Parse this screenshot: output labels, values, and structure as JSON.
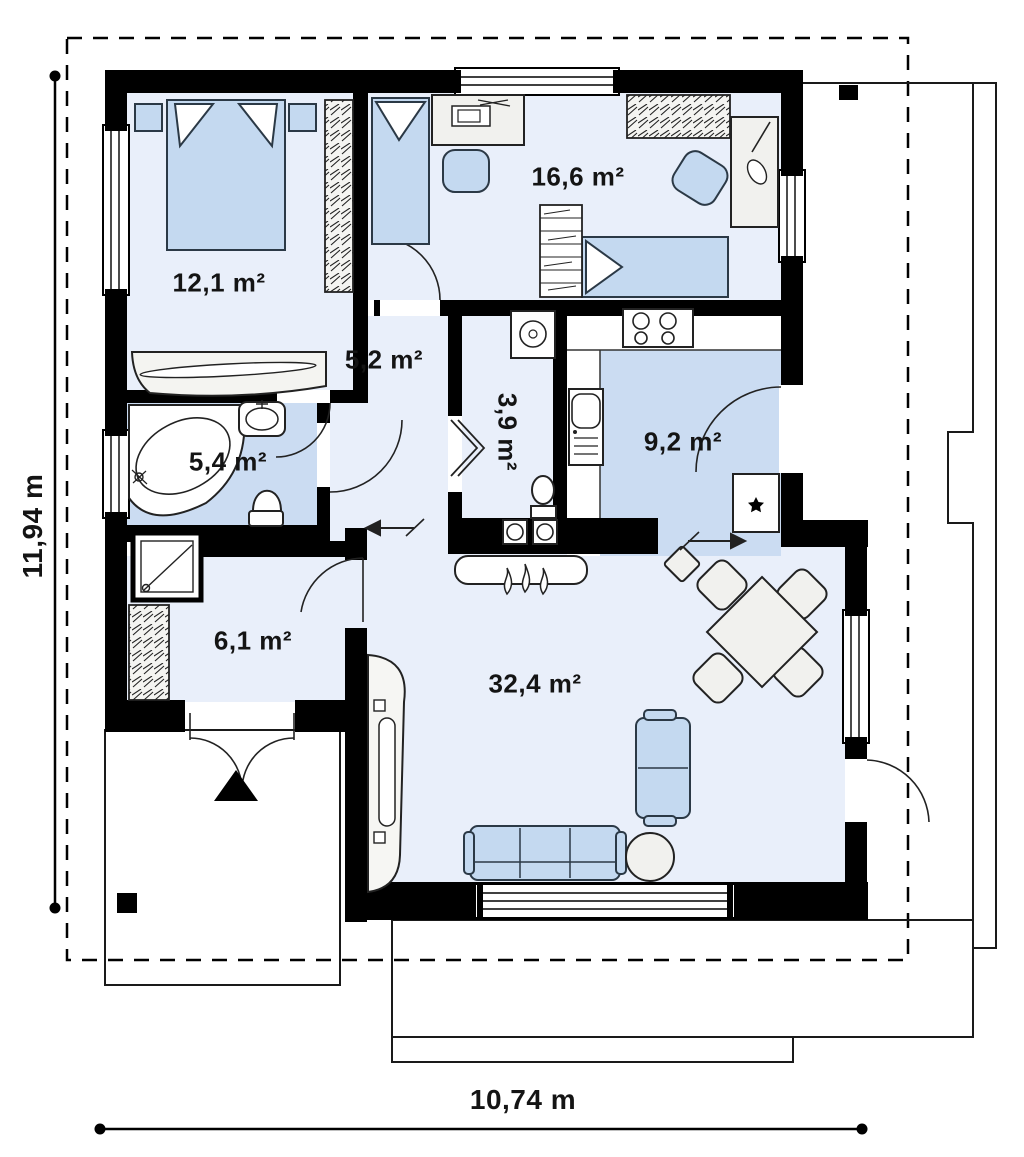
{
  "title": "Single-storey house floor plan",
  "plan": {
    "rooms": [
      {
        "name": "bedroom",
        "area_label": "12,1 m²"
      },
      {
        "name": "childrens-room",
        "area_label": "16,6 m²"
      },
      {
        "name": "inner-hall",
        "area_label": "5,2 m²"
      },
      {
        "name": "utility-wc",
        "area_label": "3,9 m²"
      },
      {
        "name": "kitchen",
        "area_label": "9,2 m²"
      },
      {
        "name": "bathroom",
        "area_label": "5,4 m²"
      },
      {
        "name": "entry-hall",
        "area_label": "6,1 m²"
      },
      {
        "name": "living-room",
        "area_label": "32,4 m²"
      }
    ],
    "dimensions": {
      "height_label": "11,94 m",
      "width_label": "10,74 m"
    },
    "colors": {
      "wall": "#000000",
      "floor": "#e9effa",
      "wet_floor": "#cbdcf2",
      "furniture_blue": "#c4d9f0",
      "furniture_grey": "#f1f1ee",
      "outline": "#1a1a1a"
    },
    "icons": [
      "double-bed",
      "single-bed",
      "wardrobe",
      "desk",
      "chair",
      "bathtub",
      "washbasin",
      "toilet",
      "shower",
      "washing-machine",
      "stove",
      "kitchen-sink",
      "fridge",
      "sofa",
      "coffee-table",
      "dining-table",
      "fireplace",
      "radiator",
      "entrance-triangle",
      "flow-arrow"
    ]
  }
}
